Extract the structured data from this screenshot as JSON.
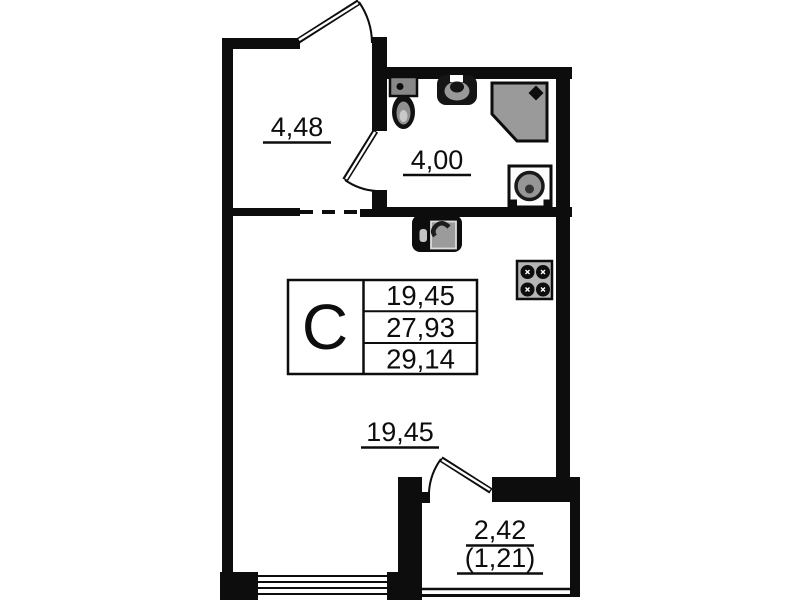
{
  "unit": {
    "type_label": "C"
  },
  "rooms": {
    "hallway": {
      "area": "4,48"
    },
    "bathroom": {
      "area": "4,00"
    },
    "living": {
      "area": "19,45"
    },
    "balcony": {
      "area": "2,42",
      "area_with_coefficient": "(1,21)"
    }
  },
  "area_table": {
    "unit_type": "C",
    "rows": [
      "19,45",
      "27,93",
      "29,14"
    ]
  },
  "fixtures": {
    "bathroom": [
      "toilet",
      "sink",
      "shower",
      "washing-machine"
    ],
    "kitchen": [
      "kitchen-sink",
      "stove-4-burners"
    ]
  },
  "colors": {
    "wall": "#0d0d0d",
    "background": "#ffffff",
    "shower_fill": "#9a9a9a",
    "stove_fill": "#b5b5b5"
  }
}
